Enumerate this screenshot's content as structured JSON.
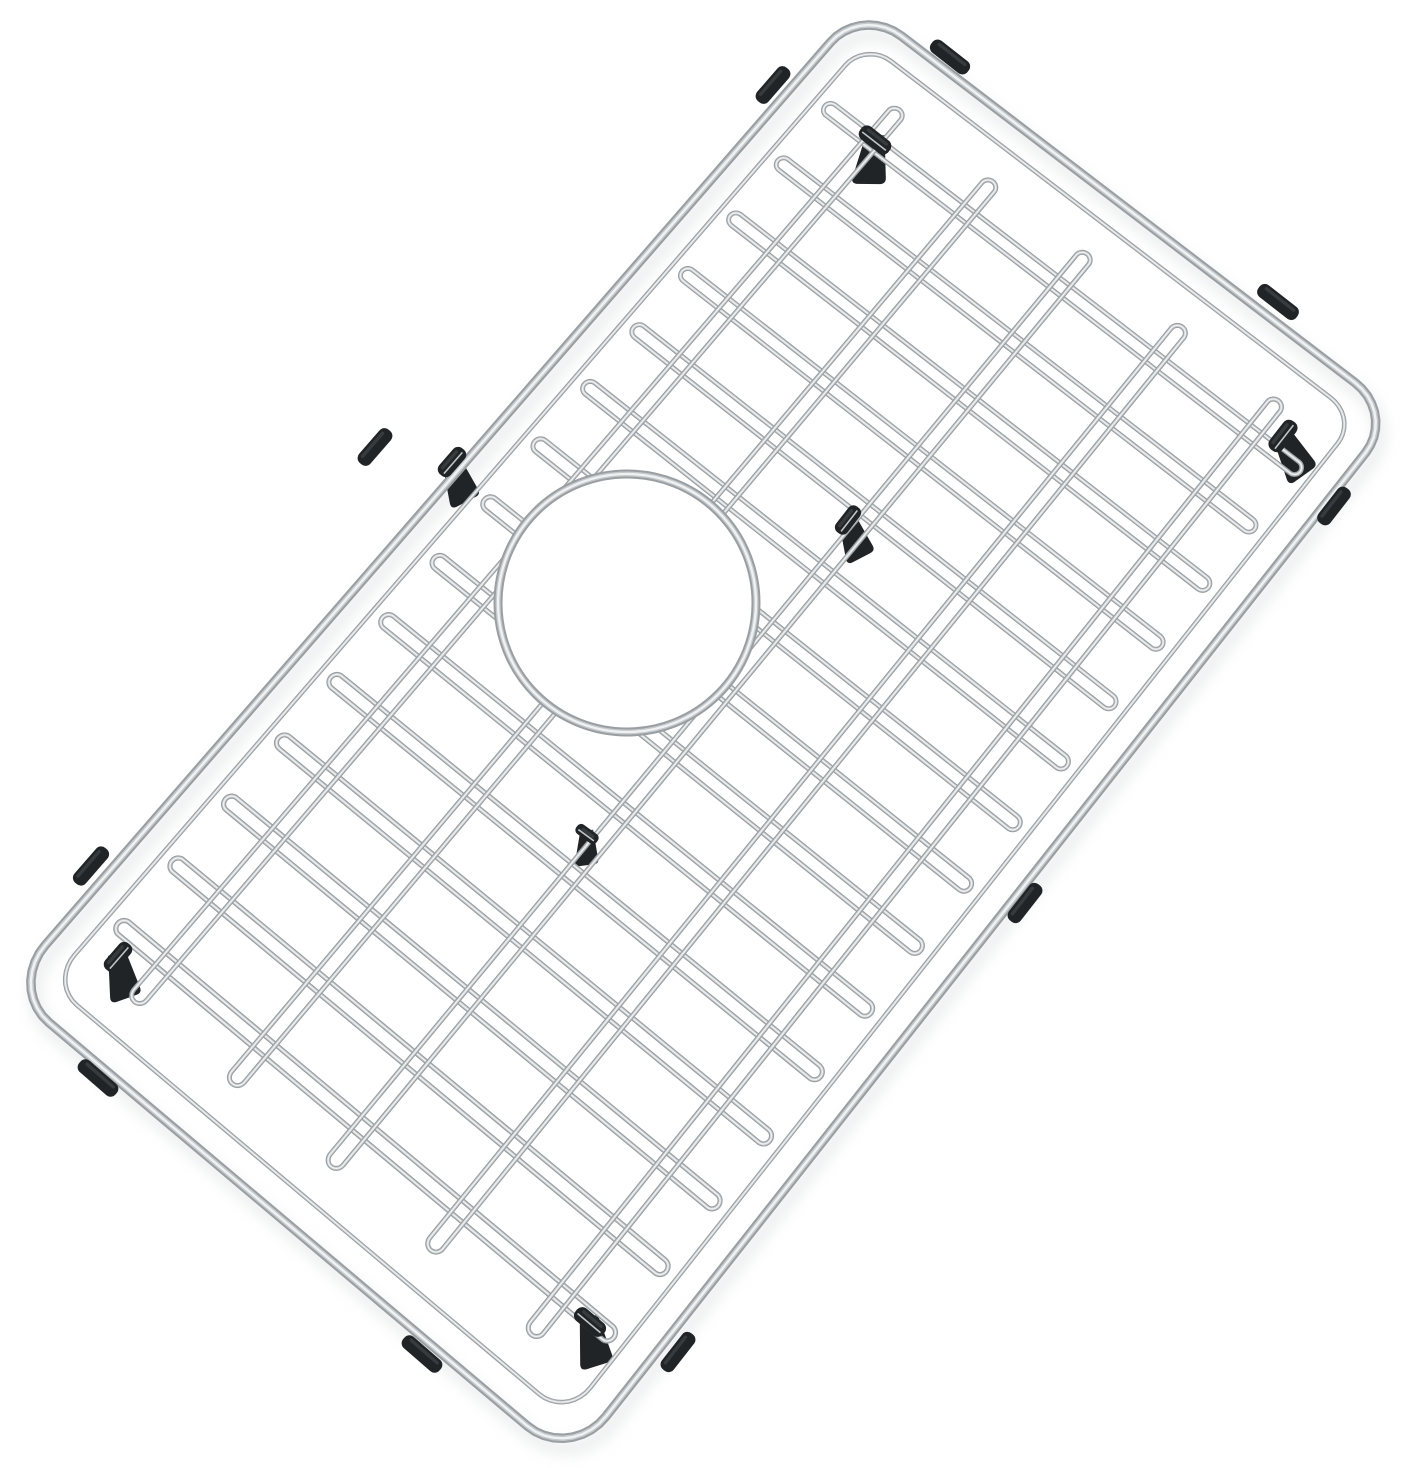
{
  "scene": {
    "kind": "product-photo",
    "alt": "Stainless steel kitchen sink bottom grid with rounded corners, a circular drain opening left of center, and black rubber feet and side bumpers, photographed tilted on a plain white background",
    "background": "#ffffff"
  },
  "palette": {
    "wire_shadow": "#999ea2",
    "wire_mid": "#c6c9cb",
    "wire_highlight": "#eff1f2",
    "rubber": "#212427",
    "rubber_sheen": "#3c4042",
    "rubber_edge": "#4a4e50",
    "glint": "#d3d6d7",
    "shadow": "#d6d9da"
  },
  "geometry": {
    "canvas": {
      "width": 1405,
      "height": 1468
    },
    "corners": {
      "top": [
        862,
        6
      ],
      "right": [
        1396,
        414
      ],
      "bottom": [
        570,
        1462
      ],
      "left": [
        8,
        988
      ]
    },
    "outer_frame": {
      "radius_u": 0.04,
      "radius_v": 0.0745,
      "stroke": 9.5
    },
    "inner_frame": {
      "u1": 0.022,
      "v1": 0.04,
      "u2": 0.978,
      "v2": 0.96,
      "radius_u": 0.026,
      "radius_v": 0.048,
      "stroke": 4.6
    },
    "cross_pairs": {
      "count": 15,
      "u_start": 0.085,
      "u_end": 0.915,
      "half_gap": 0.0058,
      "v1": 0.057,
      "v2": 0.943,
      "stroke": 5.0
    },
    "long_pairs": {
      "v_positions": [
        0.146,
        0.323,
        0.5,
        0.677,
        0.854
      ],
      "half_gap": 0.0115,
      "u1": 0.05,
      "u2": 0.95,
      "stroke": 5.0
    },
    "drain_opening": {
      "cx": 627,
      "cy": 603,
      "r": 129,
      "stroke": 9.0
    }
  },
  "rubber_parts": {
    "bumper_thickness": 15,
    "edge_bumpers": [
      {
        "cx": 950,
        "cy": 57,
        "angle": 38,
        "length": 46
      },
      {
        "cx": 1278,
        "cy": 302,
        "angle": 38,
        "length": 48
      },
      {
        "cx": 773,
        "cy": 85,
        "angle": -49,
        "length": 44
      },
      {
        "cx": 375,
        "cy": 447,
        "angle": -49,
        "length": 44
      },
      {
        "cx": 91,
        "cy": 866,
        "angle": -49,
        "length": 46
      },
      {
        "cx": 1334,
        "cy": 506,
        "angle": -52,
        "length": 44
      },
      {
        "cx": 1025,
        "cy": 903,
        "angle": -52,
        "length": 46
      },
      {
        "cx": 678,
        "cy": 1352,
        "angle": -52,
        "length": 46
      },
      {
        "cx": 98,
        "cy": 1078,
        "angle": 41,
        "length": 48
      },
      {
        "cx": 422,
        "cy": 1354,
        "angle": 41,
        "length": 48
      }
    ],
    "feet": [
      {
        "cx": 875,
        "cy": 140,
        "angle": 38,
        "lean": 8,
        "scale": 1.0
      },
      {
        "cx": 1283,
        "cy": 436,
        "angle": -52,
        "lean": -28,
        "scale": 1.0
      },
      {
        "cx": 452,
        "cy": 462,
        "angle": -49,
        "lean": -20,
        "scale": 0.95
      },
      {
        "cx": 848,
        "cy": 520,
        "angle": -52,
        "lean": -20,
        "scale": 0.9
      },
      {
        "cx": 587,
        "cy": 834,
        "angle": 36,
        "lean": 0,
        "scale": 0.7
      },
      {
        "cx": 118,
        "cy": 957,
        "angle": -49,
        "lean": -12,
        "scale": 0.95
      },
      {
        "cx": 590,
        "cy": 1322,
        "angle": 40,
        "lean": -10,
        "scale": 1.0
      }
    ]
  }
}
